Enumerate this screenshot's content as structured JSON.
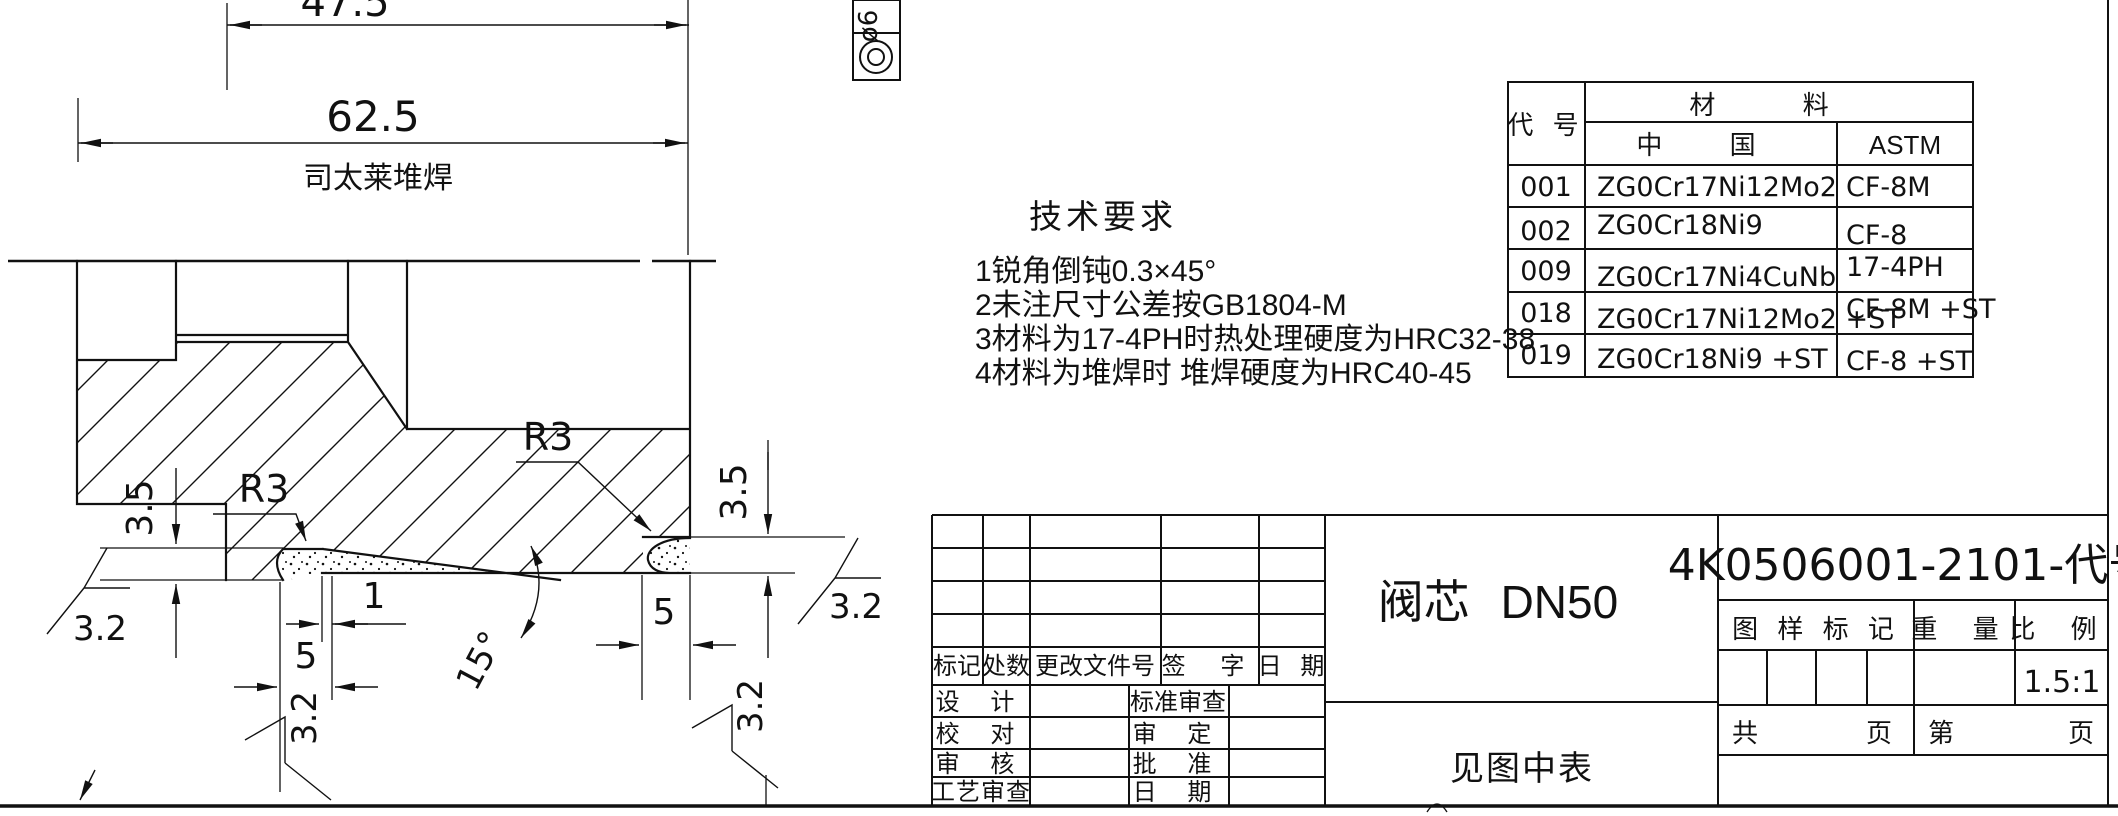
{
  "sheet": {
    "weld_note": "司太莱堆焊",
    "dim_47_5": "47.5",
    "dim_62_5": "62.5",
    "dim_3_5": "3.5",
    "dim_r3": "R3",
    "dim_1": "1",
    "dim_5": "5",
    "angle_15": "15°",
    "roughness": "3.2",
    "datum_dia": "ø6"
  },
  "tech_requirements": {
    "title": "技术要求",
    "lines": [
      "1锐角倒钝0.3×45°",
      "2未注尺寸公差按GB1804-M",
      "3材料为17-4PH时热处理硬度为HRC32-38",
      "4材料为堆焊时  堆焊硬度为HRC40-45"
    ]
  },
  "materials_table": {
    "col_code": "代 号",
    "col_material": "材 料",
    "col_china": "中 国",
    "col_astm": "ASTM",
    "rows": [
      {
        "code": "001",
        "china": "ZG0Cr17Ni12Mo2",
        "astm": "CF-8M"
      },
      {
        "code": "002",
        "china": "ZG0Cr18Ni9",
        "astm": "CF-8"
      },
      {
        "code": "009",
        "china": "ZG0Cr17Ni4CuNb",
        "astm": "17-4PH"
      },
      {
        "code": "018",
        "china": "ZG0Cr17Ni12Mo2 +ST",
        "astm": "CF-8M +ST"
      },
      {
        "code": "019",
        "china": "ZG0Cr18Ni9 +ST",
        "astm": "CF-8 +ST"
      }
    ]
  },
  "title_block": {
    "part_name": "阀芯 DN50",
    "drawing_no": "4K0506001-2101-代号",
    "material_ref": "见图中表",
    "stamp_header": "图 样 标 记",
    "weight_header": "重 量",
    "scale_header": "比 例",
    "scale_value": "1.5:1",
    "total_label": "共",
    "page_label": "页",
    "no_label": "第",
    "page_label2": "页",
    "rev": {
      "mark": "标记",
      "qty": "处数",
      "doc": "更改文件号",
      "sign": "签 字",
      "date": "日 期"
    },
    "roles": {
      "design": "设 计",
      "check": "校 对",
      "review": "审 核",
      "process": "工艺审查",
      "std_review": "标准审查",
      "ratify": "审 定",
      "approve": "批 准",
      "date": "日 期"
    }
  }
}
